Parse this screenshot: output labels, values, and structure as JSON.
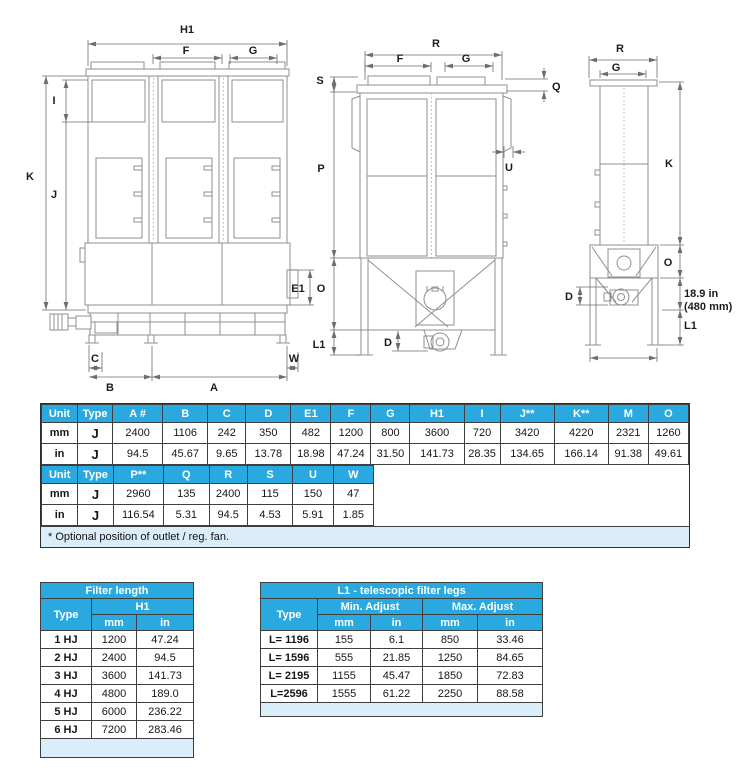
{
  "colors": {
    "header_bg": "#29A9E0",
    "note_bg": "#DBEDF9",
    "grid": "#3f3f3f",
    "drawing_line": "#8f8f8f"
  },
  "drawing_labels": {
    "front": {
      "h1": "H1",
      "f": "F",
      "g": "G",
      "i": "I",
      "k": "K",
      "j": "J",
      "e1": "E1",
      "c": "C",
      "b": "B",
      "a": "A",
      "w": "W"
    },
    "side": {
      "r": "R",
      "f": "F",
      "g": "G",
      "q": "Q",
      "s": "S",
      "p": "P",
      "u": "U",
      "o": "O",
      "l1": "L1",
      "d": "D"
    },
    "rear": {
      "r": "R",
      "g": "G",
      "k": "K",
      "o": "O",
      "d": "D",
      "l1": "L1",
      "note_line1": "18.9 in",
      "note_line2": "(480 mm)"
    }
  },
  "dim_table": {
    "part1": {
      "headers": [
        "Unit",
        "Type",
        "A #",
        "B",
        "C",
        "D",
        "E1",
        "F",
        "G",
        "H1",
        "I",
        "J**",
        "K**",
        "M",
        "O"
      ],
      "rows": [
        [
          "mm",
          "J",
          "2400",
          "1106",
          "242",
          "350",
          "482",
          "1200",
          "800",
          "3600",
          "720",
          "3420",
          "4220",
          "2321",
          "1260"
        ],
        [
          "in",
          "J",
          "94.5",
          "45.67",
          "9.65",
          "13.78",
          "18.98",
          "47.24",
          "31.50",
          "141.73",
          "28.35",
          "134.65",
          "166.14",
          "91.38",
          "49.61"
        ]
      ]
    },
    "part2": {
      "headers": [
        "Unit",
        "Type",
        "P**",
        "Q",
        "R",
        "S",
        "U",
        "W"
      ],
      "rows": [
        [
          "mm",
          "J",
          "2960",
          "135",
          "2400",
          "115",
          "150",
          "47"
        ],
        [
          "in",
          "J",
          "116.54",
          "5.31",
          "94.5",
          "4.53",
          "5.91",
          "1.85"
        ]
      ]
    },
    "footnote": "* Optional position of outlet / reg. fan."
  },
  "filter_length_table": {
    "title": "Filter length",
    "col_type": "Type",
    "col_h1": "H1",
    "col_mm": "mm",
    "col_in": "in",
    "rows": [
      [
        "1 HJ",
        "1200",
        "47.24"
      ],
      [
        "2 HJ",
        "2400",
        "94.5"
      ],
      [
        "3 HJ",
        "3600",
        "141.73"
      ],
      [
        "4 HJ",
        "4800",
        "189.0"
      ],
      [
        "5 HJ",
        "6000",
        "236.22"
      ],
      [
        "6 HJ",
        "7200",
        "283.46"
      ]
    ]
  },
  "legs_table": {
    "title": "L1 - telescopic filter legs",
    "col_type": "Type",
    "col_min": "Min. Adjust",
    "col_max": "Max. Adjust",
    "col_mm": "mm",
    "col_in": "in",
    "rows": [
      [
        "L= 1196",
        "155",
        "6.1",
        "850",
        "33.46"
      ],
      [
        "L= 1596",
        "555",
        "21.85",
        "1250",
        "84.65"
      ],
      [
        "L= 2195",
        "1155",
        "45.47",
        "1850",
        "72.83"
      ],
      [
        "L=2596",
        "1555",
        "61.22",
        "2250",
        "88.58"
      ]
    ]
  }
}
